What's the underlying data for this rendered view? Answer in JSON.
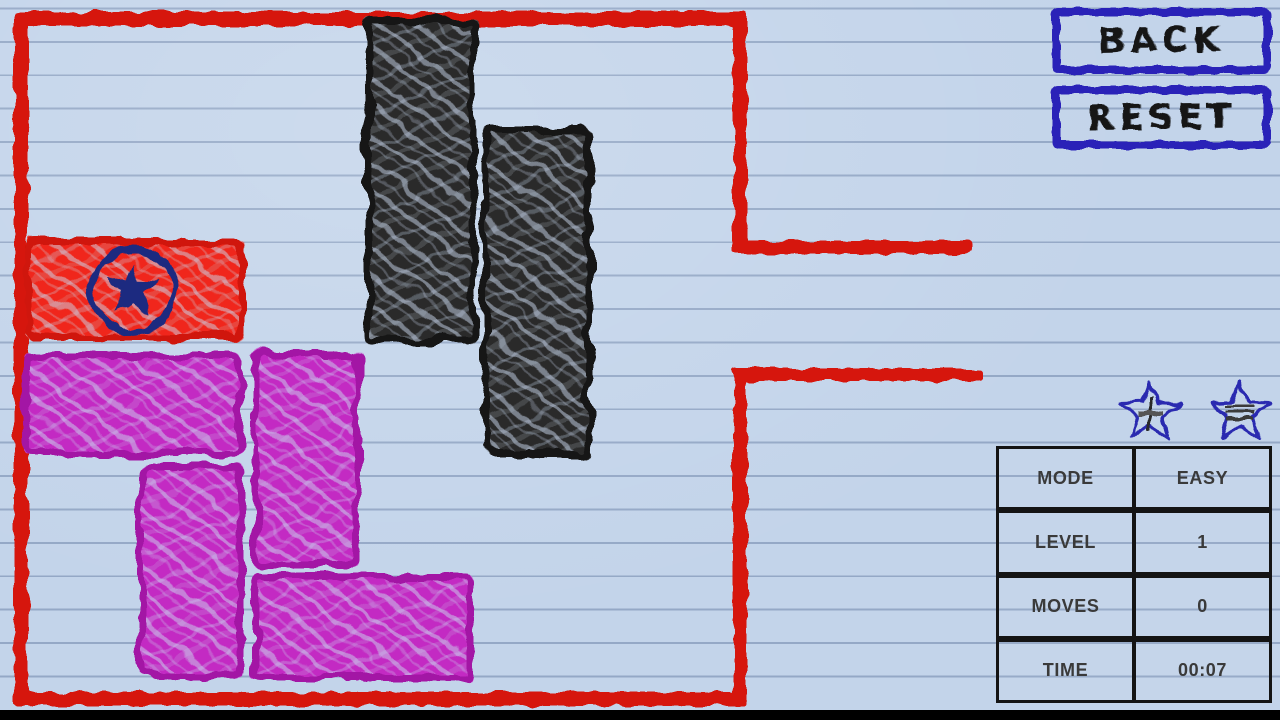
{
  "buttons": {
    "back_label": "BACK",
    "reset_label": "RESET"
  },
  "hud": {
    "rows": [
      {
        "label": "MODE",
        "value": "EASY"
      },
      {
        "label": "LEVEL",
        "value": "1"
      },
      {
        "label": "MOVES",
        "value": "0"
      },
      {
        "label": "TIME",
        "value": "00:07"
      }
    ],
    "stars": [
      {
        "cx": 1150,
        "cy": 413,
        "glyph": "plus"
      },
      {
        "cx": 1240,
        "cy": 413,
        "glyph": "lines"
      }
    ]
  },
  "colors": {
    "paper": "#c3d4ea",
    "rule_line": "#94a8c6",
    "wall": "#d6190c",
    "emblem_navy": "#1b2a80",
    "button_border": "#2a23b8",
    "button_text": "#151515",
    "hud_star": "#2a2ab0",
    "table_border": "#141414",
    "table_text": "#3a3a3a",
    "bottom_bar": "#000000",
    "blocks": {
      "red": {
        "fill": "#f0281b",
        "edge": "#d01508"
      },
      "black": {
        "fill": "#2b2b2b",
        "edge": "#161616"
      },
      "magenta": {
        "fill": "#c32bc3",
        "edge": "#a315a5"
      }
    }
  },
  "board": {
    "walls": [
      {
        "name": "wall-top",
        "x": 14,
        "y": 12,
        "w": 733,
        "h": 14
      },
      {
        "name": "wall-left",
        "x": 14,
        "y": 12,
        "w": 14,
        "h": 694
      },
      {
        "name": "wall-bottom",
        "x": 14,
        "y": 692,
        "w": 733,
        "h": 14
      },
      {
        "name": "wall-right-upper",
        "x": 733,
        "y": 12,
        "w": 14,
        "h": 242
      },
      {
        "name": "wall-right-lower",
        "x": 733,
        "y": 368,
        "w": 14,
        "h": 338
      }
    ],
    "exit_lines": [
      {
        "name": "exit-wall-upper",
        "x": 733,
        "y": 241,
        "w": 238,
        "h": 13
      },
      {
        "name": "exit-wall-lower",
        "x": 733,
        "y": 368,
        "w": 250,
        "h": 13
      }
    ],
    "blocks": [
      {
        "id": "target-block-red",
        "color": "red",
        "x": 25,
        "y": 239,
        "w": 220,
        "h": 101,
        "emblem": true
      },
      {
        "id": "block-black-vertical-1",
        "color": "black",
        "x": 366,
        "y": 18,
        "w": 110,
        "h": 326
      },
      {
        "id": "block-black-vertical-2",
        "color": "black",
        "x": 482,
        "y": 127,
        "w": 110,
        "h": 330
      },
      {
        "id": "block-magenta-horizontal-1",
        "color": "magenta",
        "x": 23,
        "y": 352,
        "w": 220,
        "h": 104
      },
      {
        "id": "block-magenta-vertical-1",
        "color": "magenta",
        "x": 253,
        "y": 350,
        "w": 108,
        "h": 218
      },
      {
        "id": "block-magenta-vertical-2",
        "color": "magenta",
        "x": 138,
        "y": 464,
        "w": 106,
        "h": 214
      },
      {
        "id": "block-magenta-horizontal-2",
        "color": "magenta",
        "x": 252,
        "y": 574,
        "w": 221,
        "h": 107
      }
    ]
  }
}
